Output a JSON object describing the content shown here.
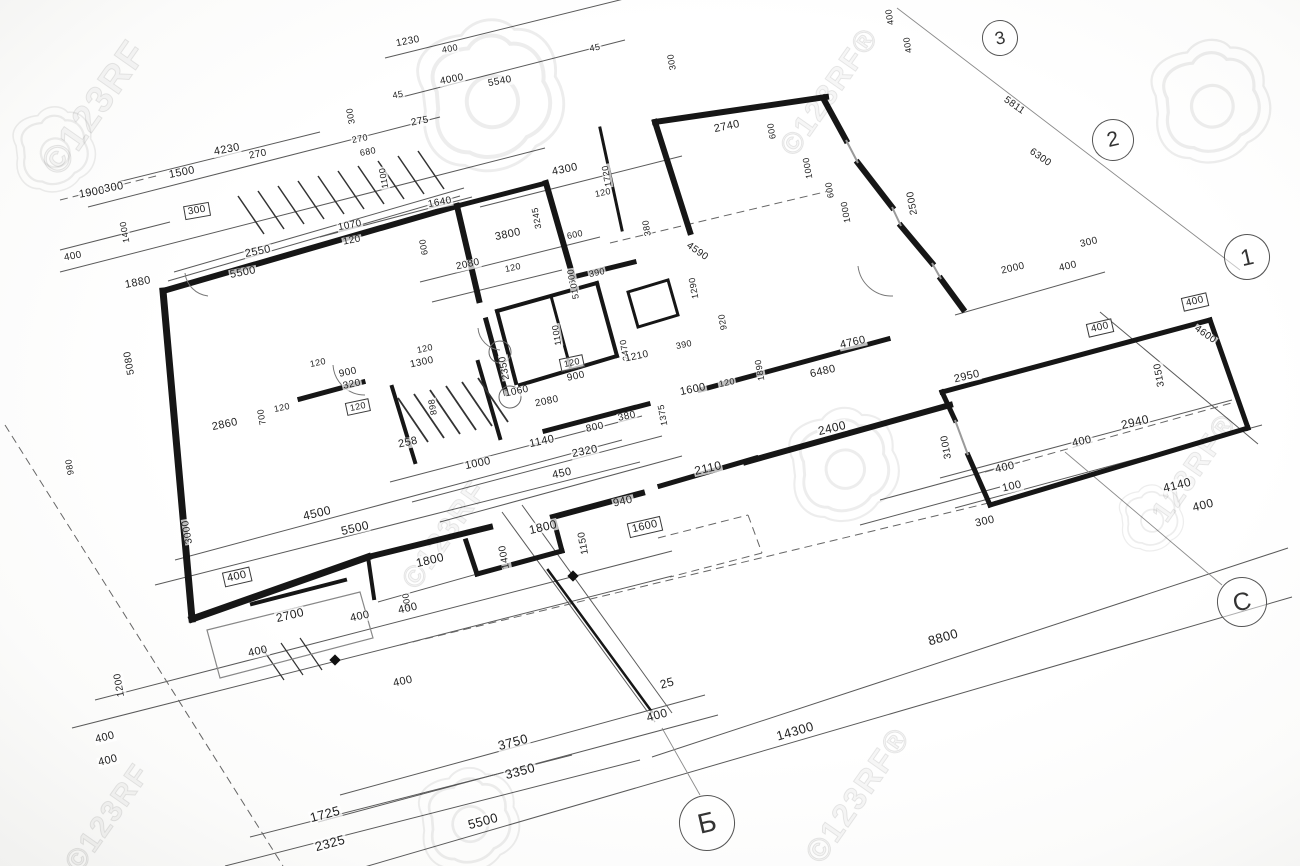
{
  "page": {
    "type": "architectural floor plan blueprint photograph",
    "paper_color": "#ffffff",
    "line_color": "#1b1b1b"
  },
  "watermark": {
    "brand": "123RF",
    "camera_icon_color": "rgba(0,0,0,0.07)",
    "text_items": [
      {
        "t": "©123RF",
        "x": 95,
        "y": 108,
        "r": -55,
        "s": 38
      },
      {
        "t": "©123RF®",
        "x": 830,
        "y": 92,
        "r": -55,
        "s": 30
      },
      {
        "t": "©123RF",
        "x": 445,
        "y": 535,
        "r": -55,
        "s": 30
      },
      {
        "t": "123RF®",
        "x": 1195,
        "y": 468,
        "r": -55,
        "s": 30
      },
      {
        "t": "©123RF",
        "x": 108,
        "y": 818,
        "r": -55,
        "s": 30
      },
      {
        "t": "©123RF®",
        "x": 858,
        "y": 795,
        "r": -55,
        "s": 32
      }
    ],
    "camera_icons": [
      {
        "x": 55,
        "y": 152,
        "s": 0.9
      },
      {
        "x": 492,
        "y": 100,
        "s": 1.6
      },
      {
        "x": 1212,
        "y": 105,
        "s": 1.3
      },
      {
        "x": 845,
        "y": 468,
        "s": 1.2
      },
      {
        "x": 470,
        "y": 823,
        "s": 1.1
      },
      {
        "x": 1152,
        "y": 520,
        "s": 0.7
      }
    ]
  },
  "grid_bubbles": [
    {
      "label": "3",
      "x": 1000,
      "y": 38,
      "d": 34
    },
    {
      "label": "2",
      "x": 1113,
      "y": 140,
      "d": 40
    },
    {
      "label": "1",
      "x": 1247,
      "y": 257,
      "d": 44
    },
    {
      "label": "C",
      "x": 1242,
      "y": 602,
      "d": 48
    },
    {
      "label": "Б",
      "x": 707,
      "y": 823,
      "d": 54
    }
  ],
  "dimension_labels": [
    {
      "t": "1230",
      "x": 408,
      "y": 42,
      "r": -11,
      "s": 10
    },
    {
      "t": "400",
      "x": 450,
      "y": 49,
      "r": -11,
      "s": 9
    },
    {
      "t": "4000",
      "x": 452,
      "y": 80,
      "r": -11,
      "s": 10
    },
    {
      "t": "5540",
      "x": 500,
      "y": 82,
      "r": -11,
      "s": 10
    },
    {
      "t": "45",
      "x": 398,
      "y": 95,
      "r": -11,
      "s": 9
    },
    {
      "t": "275",
      "x": 420,
      "y": 122,
      "r": -11,
      "s": 10
    },
    {
      "t": "45",
      "x": 595,
      "y": 48,
      "r": -11,
      "s": 9
    },
    {
      "t": "300",
      "x": 672,
      "y": 62,
      "r": -100,
      "s": 9
    },
    {
      "t": "400",
      "x": 890,
      "y": 17,
      "r": -100,
      "s": 9
    },
    {
      "t": "400",
      "x": 908,
      "y": 45,
      "r": -100,
      "s": 9
    },
    {
      "t": "4230",
      "x": 227,
      "y": 150,
      "r": -11,
      "s": 11
    },
    {
      "t": "270",
      "x": 258,
      "y": 155,
      "r": -11,
      "s": 10
    },
    {
      "t": "1500",
      "x": 182,
      "y": 173,
      "r": -11,
      "s": 11
    },
    {
      "t": "1900",
      "x": 92,
      "y": 193,
      "r": -10,
      "s": 11
    },
    {
      "t": "300",
      "x": 114,
      "y": 188,
      "r": -10,
      "s": 11
    },
    {
      "t": "300",
      "x": 197,
      "y": 211,
      "r": -10,
      "s": 10,
      "b": 1
    },
    {
      "t": "1070",
      "x": 350,
      "y": 226,
      "r": -11,
      "s": 10
    },
    {
      "t": "120",
      "x": 352,
      "y": 241,
      "r": -11,
      "s": 10
    },
    {
      "t": "1640",
      "x": 440,
      "y": 203,
      "r": -11,
      "s": 10
    },
    {
      "t": "300",
      "x": 351,
      "y": 116,
      "r": -100,
      "s": 9
    },
    {
      "t": "270",
      "x": 360,
      "y": 139,
      "r": -11,
      "s": 9
    },
    {
      "t": "680",
      "x": 368,
      "y": 152,
      "r": -11,
      "s": 9
    },
    {
      "t": "1100",
      "x": 384,
      "y": 178,
      "r": -100,
      "s": 9
    },
    {
      "t": "600",
      "x": 424,
      "y": 247,
      "r": -100,
      "s": 9
    },
    {
      "t": "4300",
      "x": 565,
      "y": 170,
      "r": -12,
      "s": 11
    },
    {
      "t": "1720",
      "x": 607,
      "y": 176,
      "r": -100,
      "s": 9
    },
    {
      "t": "120",
      "x": 603,
      "y": 193,
      "r": -12,
      "s": 9
    },
    {
      "t": "2740",
      "x": 727,
      "y": 127,
      "r": -12,
      "s": 11
    },
    {
      "t": "600",
      "x": 772,
      "y": 131,
      "r": -100,
      "s": 9
    },
    {
      "t": "1000",
      "x": 808,
      "y": 168,
      "r": -100,
      "s": 9
    },
    {
      "t": "600",
      "x": 830,
      "y": 190,
      "r": -100,
      "s": 9
    },
    {
      "t": "1000",
      "x": 846,
      "y": 212,
      "r": -100,
      "s": 9
    },
    {
      "t": "2500",
      "x": 913,
      "y": 203,
      "r": -100,
      "s": 10
    },
    {
      "t": "5811",
      "x": 1014,
      "y": 106,
      "r": 35,
      "s": 10
    },
    {
      "t": "6300",
      "x": 1040,
      "y": 158,
      "r": 35,
      "s": 10
    },
    {
      "t": "3245",
      "x": 537,
      "y": 218,
      "r": -100,
      "s": 9
    },
    {
      "t": "3800",
      "x": 508,
      "y": 235,
      "r": -12,
      "s": 11
    },
    {
      "t": "2080",
      "x": 468,
      "y": 265,
      "r": -12,
      "s": 10
    },
    {
      "t": "120",
      "x": 513,
      "y": 268,
      "r": -12,
      "s": 9
    },
    {
      "t": "600",
      "x": 575,
      "y": 235,
      "r": -12,
      "s": 9
    },
    {
      "t": "390",
      "x": 597,
      "y": 273,
      "r": -12,
      "s": 9
    },
    {
      "t": "600",
      "x": 572,
      "y": 277,
      "r": -100,
      "s": 9
    },
    {
      "t": "510",
      "x": 575,
      "y": 291,
      "r": -100,
      "s": 9
    },
    {
      "t": "1100",
      "x": 557,
      "y": 335,
      "r": -100,
      "s": 9
    },
    {
      "t": "2350",
      "x": 505,
      "y": 368,
      "r": -100,
      "s": 10
    },
    {
      "t": "1060",
      "x": 517,
      "y": 392,
      "r": -12,
      "s": 10
    },
    {
      "t": "120",
      "x": 572,
      "y": 363,
      "r": -12,
      "s": 9,
      "b": 1
    },
    {
      "t": "900",
      "x": 576,
      "y": 377,
      "r": -12,
      "s": 10
    },
    {
      "t": "2080",
      "x": 547,
      "y": 402,
      "r": -12,
      "s": 10
    },
    {
      "t": "1300",
      "x": 422,
      "y": 363,
      "r": -12,
      "s": 10
    },
    {
      "t": "120",
      "x": 425,
      "y": 349,
      "r": -12,
      "s": 9
    },
    {
      "t": "120",
      "x": 318,
      "y": 363,
      "r": -12,
      "s": 9
    },
    {
      "t": "900",
      "x": 348,
      "y": 373,
      "r": -12,
      "s": 10
    },
    {
      "t": "320",
      "x": 352,
      "y": 385,
      "r": -12,
      "s": 10
    },
    {
      "t": "120",
      "x": 358,
      "y": 407,
      "r": -12,
      "s": 9,
      "b": 1
    },
    {
      "t": "898",
      "x": 433,
      "y": 407,
      "r": -100,
      "s": 9
    },
    {
      "t": "258",
      "x": 408,
      "y": 443,
      "r": -12,
      "s": 11
    },
    {
      "t": "800",
      "x": 595,
      "y": 428,
      "r": -12,
      "s": 10
    },
    {
      "t": "1140",
      "x": 542,
      "y": 442,
      "r": -12,
      "s": 11
    },
    {
      "t": "1000",
      "x": 478,
      "y": 464,
      "r": -12,
      "s": 11
    },
    {
      "t": "2320",
      "x": 585,
      "y": 452,
      "r": -12,
      "s": 11
    },
    {
      "t": "450",
      "x": 562,
      "y": 474,
      "r": -12,
      "s": 11
    },
    {
      "t": "380",
      "x": 647,
      "y": 228,
      "r": -100,
      "s": 9
    },
    {
      "t": "4590",
      "x": 697,
      "y": 252,
      "r": 35,
      "s": 10
    },
    {
      "t": "1290",
      "x": 694,
      "y": 288,
      "r": -100,
      "s": 9
    },
    {
      "t": "920",
      "x": 723,
      "y": 322,
      "r": -100,
      "s": 9
    },
    {
      "t": "2470",
      "x": 625,
      "y": 350,
      "r": -100,
      "s": 9
    },
    {
      "t": "1210",
      "x": 637,
      "y": 357,
      "r": -12,
      "s": 10
    },
    {
      "t": "390",
      "x": 684,
      "y": 345,
      "r": -12,
      "s": 9
    },
    {
      "t": "1600",
      "x": 693,
      "y": 390,
      "r": -12,
      "s": 11
    },
    {
      "t": "120",
      "x": 727,
      "y": 383,
      "r": -12,
      "s": 9
    },
    {
      "t": "1890",
      "x": 760,
      "y": 370,
      "r": -100,
      "s": 9
    },
    {
      "t": "1375",
      "x": 663,
      "y": 415,
      "r": -100,
      "s": 9
    },
    {
      "t": "380",
      "x": 627,
      "y": 417,
      "r": -12,
      "s": 10
    },
    {
      "t": "4760",
      "x": 853,
      "y": 343,
      "r": -13,
      "s": 11
    },
    {
      "t": "6480",
      "x": 823,
      "y": 372,
      "r": -13,
      "s": 11
    },
    {
      "t": "2400",
      "x": 832,
      "y": 428,
      "r": -13,
      "s": 12
    },
    {
      "t": "1800",
      "x": 543,
      "y": 527,
      "r": -13,
      "s": 12
    },
    {
      "t": "1800",
      "x": 430,
      "y": 560,
      "r": -13,
      "s": 12
    },
    {
      "t": "1400",
      "x": 505,
      "y": 557,
      "r": -100,
      "s": 10
    },
    {
      "t": "1150",
      "x": 584,
      "y": 543,
      "r": -100,
      "s": 10
    },
    {
      "t": "400",
      "x": 407,
      "y": 601,
      "r": -100,
      "s": 9
    },
    {
      "t": "4500",
      "x": 317,
      "y": 513,
      "r": -13,
      "s": 12
    },
    {
      "t": "5500",
      "x": 355,
      "y": 528,
      "r": -13,
      "s": 12
    },
    {
      "t": "3000",
      "x": 188,
      "y": 532,
      "r": -100,
      "s": 10
    },
    {
      "t": "980",
      "x": 70,
      "y": 467,
      "r": -100,
      "s": 9
    },
    {
      "t": "5080",
      "x": 130,
      "y": 363,
      "r": -100,
      "s": 10
    },
    {
      "t": "1880",
      "x": 138,
      "y": 283,
      "r": -11,
      "s": 11
    },
    {
      "t": "2550",
      "x": 258,
      "y": 252,
      "r": -11,
      "s": 11
    },
    {
      "t": "5500",
      "x": 243,
      "y": 273,
      "r": -11,
      "s": 11
    },
    {
      "t": "1400",
      "x": 125,
      "y": 232,
      "r": -100,
      "s": 9
    },
    {
      "t": "400",
      "x": 73,
      "y": 257,
      "r": -11,
      "s": 10
    },
    {
      "t": "2860",
      "x": 225,
      "y": 425,
      "r": -12,
      "s": 11
    },
    {
      "t": "700",
      "x": 262,
      "y": 417,
      "r": -100,
      "s": 9
    },
    {
      "t": "120",
      "x": 282,
      "y": 408,
      "r": -12,
      "s": 9
    },
    {
      "t": "940",
      "x": 623,
      "y": 502,
      "r": -13,
      "s": 11
    },
    {
      "t": "2110",
      "x": 708,
      "y": 468,
      "r": -13,
      "s": 12
    },
    {
      "t": "1600",
      "x": 645,
      "y": 527,
      "r": -13,
      "s": 11,
      "b": 1
    },
    {
      "t": "2700",
      "x": 290,
      "y": 615,
      "r": -13,
      "s": 12
    },
    {
      "t": "400",
      "x": 360,
      "y": 617,
      "r": -13,
      "s": 11
    },
    {
      "t": "400",
      "x": 408,
      "y": 609,
      "r": -13,
      "s": 11
    },
    {
      "t": "400",
      "x": 258,
      "y": 652,
      "r": -13,
      "s": 11
    },
    {
      "t": "400",
      "x": 403,
      "y": 682,
      "r": -13,
      "s": 11
    },
    {
      "t": "1200",
      "x": 120,
      "y": 685,
      "r": -100,
      "s": 10
    },
    {
      "t": "400",
      "x": 105,
      "y": 738,
      "r": -14,
      "s": 11
    },
    {
      "t": "400",
      "x": 108,
      "y": 761,
      "r": -14,
      "s": 11
    },
    {
      "t": "400",
      "x": 237,
      "y": 577,
      "r": -13,
      "s": 11,
      "b": 1
    },
    {
      "t": "3750",
      "x": 513,
      "y": 742,
      "r": -15,
      "s": 13
    },
    {
      "t": "3350",
      "x": 520,
      "y": 771,
      "r": -15,
      "s": 13
    },
    {
      "t": "1725",
      "x": 325,
      "y": 814,
      "r": -15,
      "s": 13
    },
    {
      "t": "2325",
      "x": 330,
      "y": 843,
      "r": -15,
      "s": 13
    },
    {
      "t": "5500",
      "x": 483,
      "y": 821,
      "r": -15,
      "s": 13
    },
    {
      "t": "25",
      "x": 667,
      "y": 683,
      "r": -15,
      "s": 12
    },
    {
      "t": "400",
      "x": 657,
      "y": 715,
      "r": -15,
      "s": 12
    },
    {
      "t": "8800",
      "x": 943,
      "y": 637,
      "r": -16,
      "s": 13
    },
    {
      "t": "14300",
      "x": 795,
      "y": 731,
      "r": -16,
      "s": 13
    },
    {
      "t": "2000",
      "x": 1013,
      "y": 269,
      "r": -13,
      "s": 10
    },
    {
      "t": "400",
      "x": 1068,
      "y": 267,
      "r": -13,
      "s": 10
    },
    {
      "t": "300",
      "x": 1089,
      "y": 243,
      "r": -13,
      "s": 10
    },
    {
      "t": "400",
      "x": 1195,
      "y": 302,
      "r": -13,
      "s": 10,
      "b": 1
    },
    {
      "t": "4600",
      "x": 1205,
      "y": 335,
      "r": 35,
      "s": 10
    },
    {
      "t": "400",
      "x": 1100,
      "y": 328,
      "r": -13,
      "s": 10,
      "b": 1
    },
    {
      "t": "3150",
      "x": 1160,
      "y": 375,
      "r": -100,
      "s": 10
    },
    {
      "t": "2940",
      "x": 1135,
      "y": 422,
      "r": -13,
      "s": 12
    },
    {
      "t": "400",
      "x": 1082,
      "y": 442,
      "r": -13,
      "s": 11
    },
    {
      "t": "2950",
      "x": 967,
      "y": 377,
      "r": -13,
      "s": 11
    },
    {
      "t": "3100",
      "x": 947,
      "y": 447,
      "r": -100,
      "s": 10
    },
    {
      "t": "400",
      "x": 1005,
      "y": 468,
      "r": -13,
      "s": 11
    },
    {
      "t": "100",
      "x": 1012,
      "y": 487,
      "r": -13,
      "s": 11
    },
    {
      "t": "300",
      "x": 985,
      "y": 522,
      "r": -13,
      "s": 11
    },
    {
      "t": "4140",
      "x": 1177,
      "y": 485,
      "r": -14,
      "s": 12
    },
    {
      "t": "400",
      "x": 1203,
      "y": 505,
      "r": -14,
      "s": 12
    }
  ]
}
